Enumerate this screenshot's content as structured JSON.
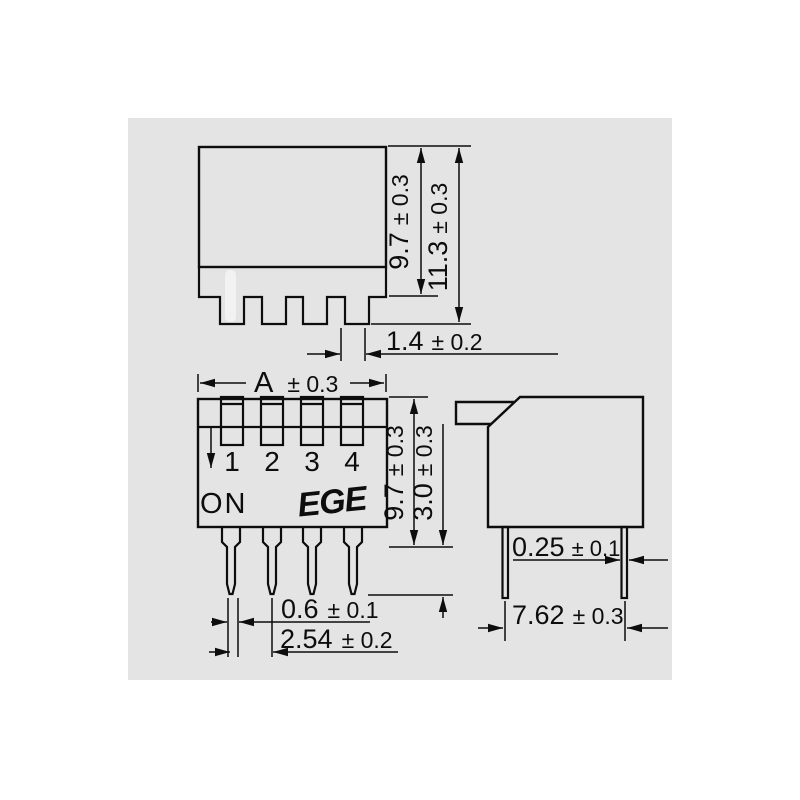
{
  "canvas": {
    "background": "#e4e4e4",
    "line_color": "#0d0d0d"
  },
  "front_view": {
    "on_label": "ON",
    "logo": "EGE",
    "switch_numbers": [
      "1",
      "2",
      "3",
      "4"
    ]
  },
  "dimensions": {
    "top_body_height": {
      "value": "9.7",
      "tolerance": "± 0.3"
    },
    "top_overall_height": {
      "value": "11.3",
      "tolerance": "± 0.3"
    },
    "top_pin_tab_width": {
      "value": "1.4",
      "tolerance": "± 0.2"
    },
    "front_width": {
      "value": "A",
      "tolerance": "± 0.3"
    },
    "front_body_height": {
      "value": "9.7",
      "tolerance": "± 0.3"
    },
    "front_pin_length": {
      "value": "3.0",
      "tolerance": "± 0.3"
    },
    "front_pin_width": {
      "value": "0.6",
      "tolerance": "± 0.1"
    },
    "front_pin_pitch": {
      "value": "2.54",
      "tolerance": "± 0.2"
    },
    "side_pin_thickness": {
      "value": "0.25",
      "tolerance": "± 0.1"
    },
    "side_row_spacing": {
      "value": "7.62",
      "tolerance": "± 0.3"
    }
  }
}
